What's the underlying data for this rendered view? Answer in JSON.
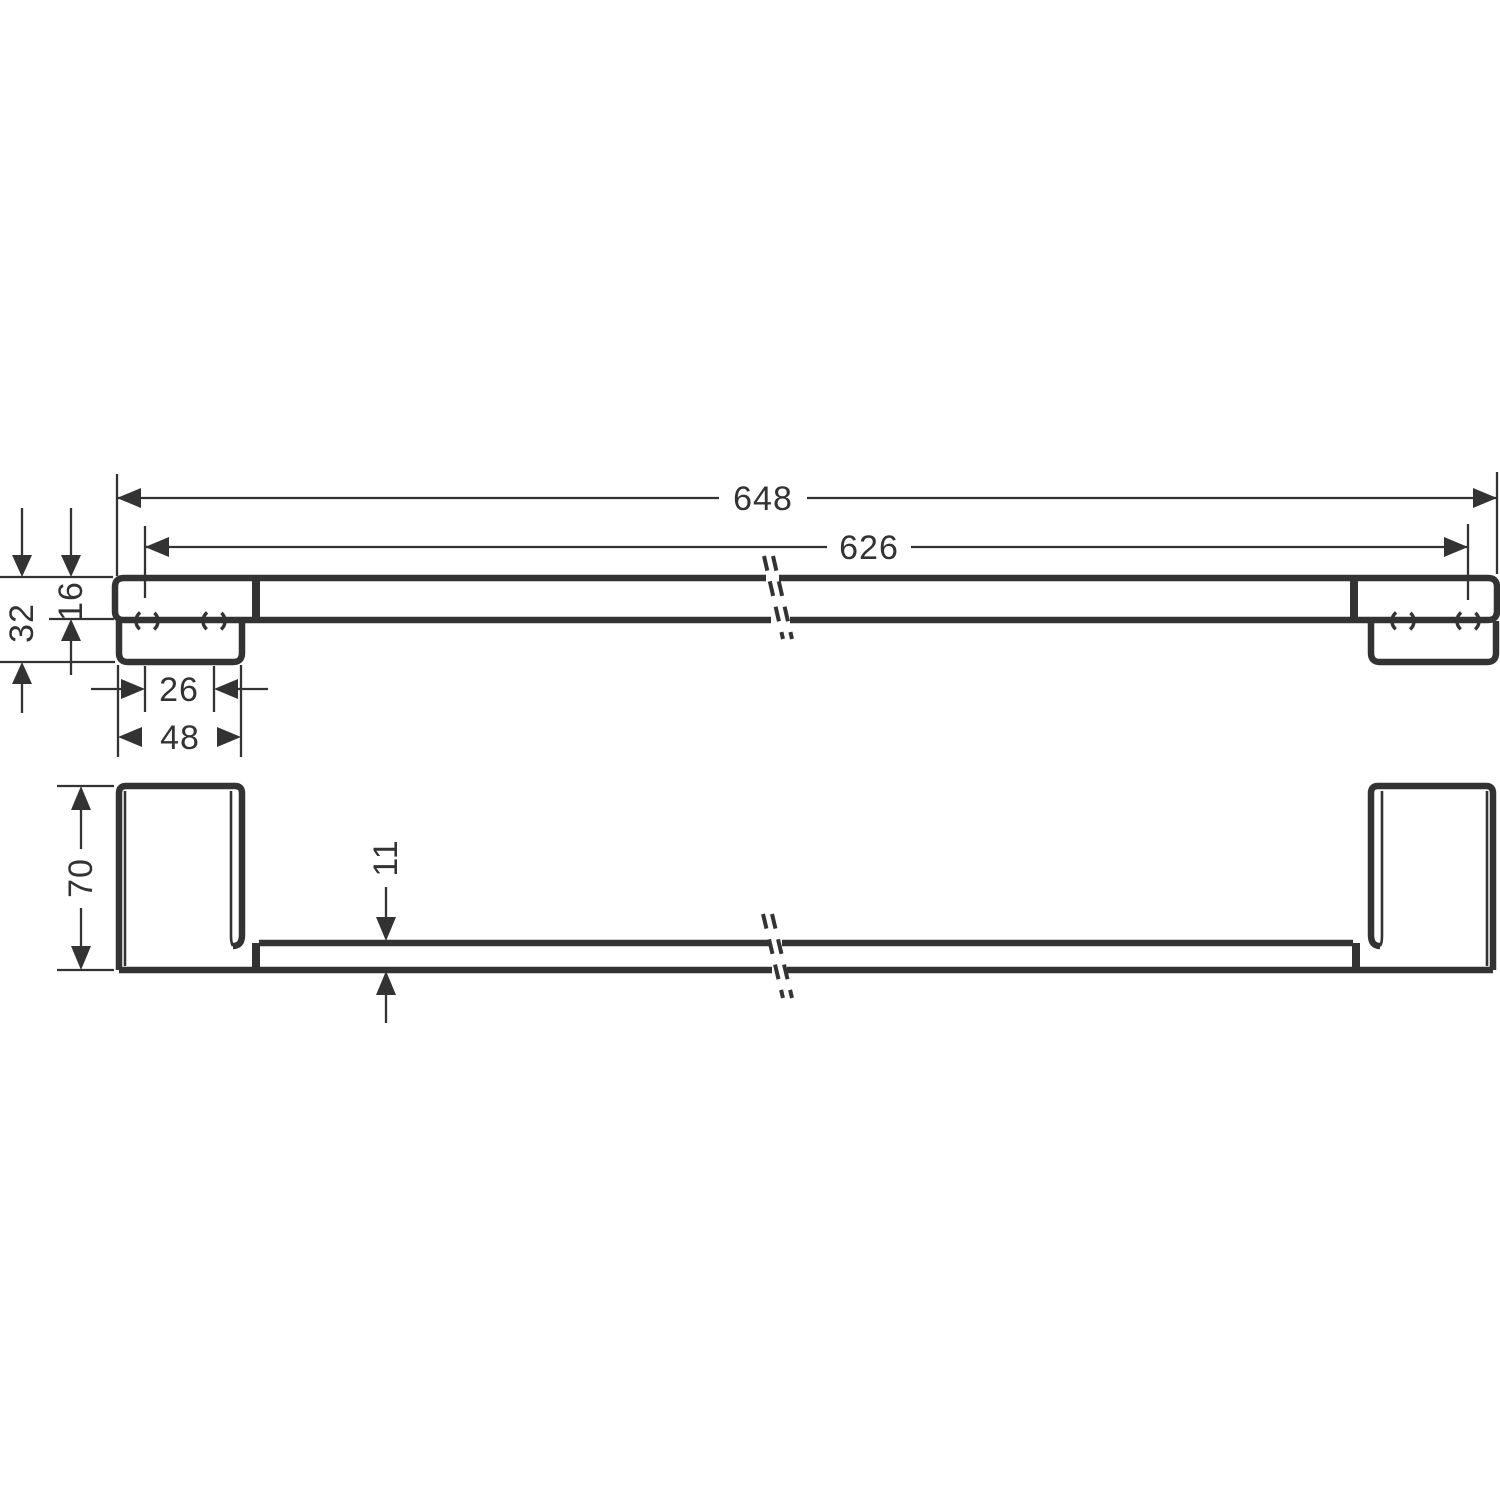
{
  "drawing": {
    "kind": "technical-dimension-drawing",
    "subject": "wall-mounted towel bar, two orthographic views with break lines",
    "colors": {
      "line": "#333333",
      "background": "#ffffff"
    },
    "dims": {
      "overall_length": "648",
      "hole_span": "626",
      "end_height": "32",
      "bar_profile_height": "16",
      "hole_spacing": "26",
      "plate_length": "48",
      "bracket_depth": "70",
      "bar_thickness": "11"
    }
  }
}
